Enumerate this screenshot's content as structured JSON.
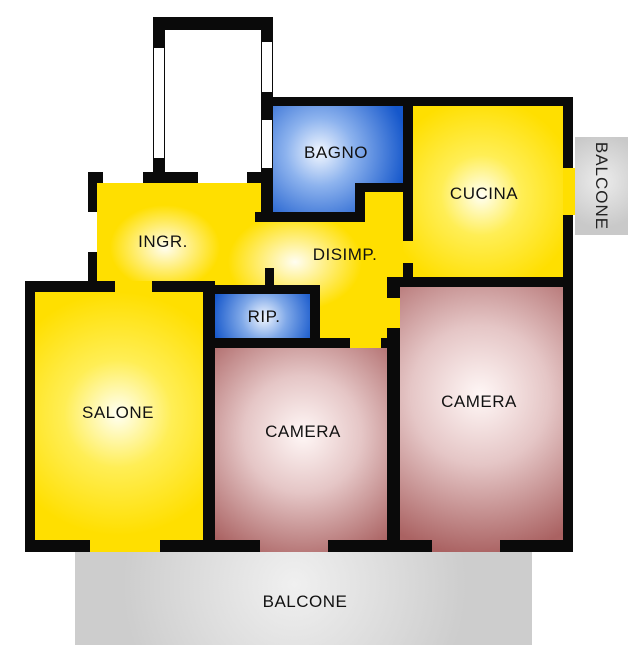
{
  "floorplan": {
    "rooms": [
      {
        "name": "bagno",
        "label": "BAGNO"
      },
      {
        "name": "cucina",
        "label": "CUCINA"
      },
      {
        "name": "ingresso",
        "label": "INGR."
      },
      {
        "name": "disimpegno",
        "label": "DISIMP."
      },
      {
        "name": "ripostiglio",
        "label": "RIP."
      },
      {
        "name": "salone",
        "label": "SALONE"
      },
      {
        "name": "camera-1",
        "label": "CAMERA"
      },
      {
        "name": "camera-2",
        "label": "CAMERA"
      },
      {
        "name": "balcone-right",
        "label": "BALCONE"
      },
      {
        "name": "balcone-bottom",
        "label": "BALCONE"
      }
    ],
    "colors": {
      "room_yellow": "#ffdf00",
      "room_blue": "#1557cb",
      "room_red": "#aa6262",
      "balcony_gray": "#cdcdcd",
      "wall_black": "#0a0a0a",
      "label_text": "#111111"
    }
  }
}
